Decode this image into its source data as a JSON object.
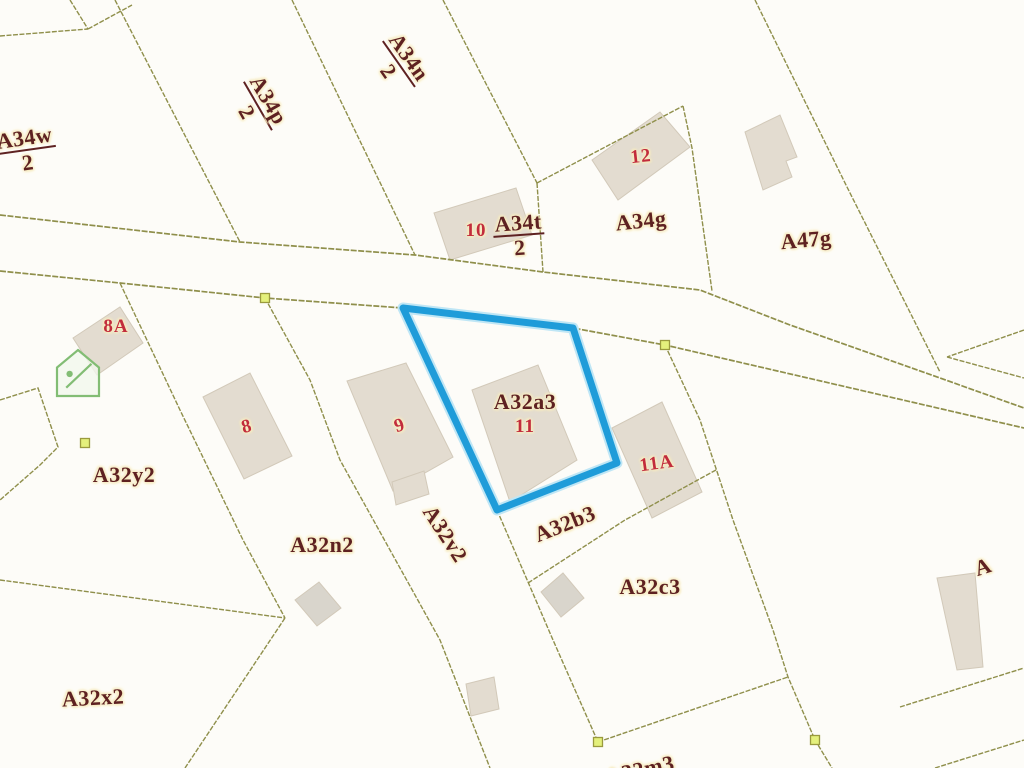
{
  "map": {
    "type": "cadastral-parcel-map",
    "highlighted_parcel": {
      "label": "A32a3",
      "house_number": "11",
      "outline_color": "#1f9cd9",
      "polygon": [
        [
          403,
          308
        ],
        [
          573,
          328
        ],
        [
          617,
          463
        ],
        [
          497,
          510
        ]
      ]
    },
    "colors": {
      "background": "#fdfcf8",
      "boundary_line": "#8f8f4b",
      "building_fill_beige": "#e3dcd0",
      "building_fill_gray": "#d9d5cc",
      "building_stroke": "#d2c9b9",
      "parcel_label": "#5e2121",
      "house_number": "#c22c3c",
      "label_halo": "#f7ecc2",
      "vertex_marker_fill": "#e4f07c",
      "vertex_marker_stroke": "#9a9a3e",
      "house_icon_green": "#82bd74"
    },
    "labels": [
      {
        "kind": "parcel",
        "fraction": [
          "A34w",
          "2"
        ],
        "x": 26,
        "y": 150,
        "rot": -8,
        "partial": true
      },
      {
        "kind": "parcel",
        "fraction": [
          "A34p",
          "2"
        ],
        "x": 258,
        "y": 106,
        "rot": 60
      },
      {
        "kind": "parcel",
        "fraction": [
          "A34n",
          "2"
        ],
        "x": 399,
        "y": 64,
        "rot": 55
      },
      {
        "kind": "parcel",
        "fraction": [
          "A34t",
          "2"
        ],
        "x": 519,
        "y": 235,
        "rot": -4
      },
      {
        "kind": "number",
        "text": "10",
        "x": 476,
        "y": 231,
        "rot": 0
      },
      {
        "kind": "parcel",
        "text": "A34g",
        "x": 641,
        "y": 221,
        "rot": -6
      },
      {
        "kind": "parcel",
        "text": "A47g",
        "x": 806,
        "y": 240,
        "rot": -5
      },
      {
        "kind": "number",
        "text": "12",
        "x": 641,
        "y": 157,
        "rot": -6
      },
      {
        "kind": "number",
        "text": "8A",
        "x": 116,
        "y": 327,
        "rot": 0
      },
      {
        "kind": "parcel",
        "text": "A32y2",
        "x": 124,
        "y": 475,
        "rot": 0
      },
      {
        "kind": "number",
        "text": "8",
        "x": 247,
        "y": 427,
        "rot": -15
      },
      {
        "kind": "number",
        "text": "9",
        "x": 400,
        "y": 426,
        "rot": -18
      },
      {
        "kind": "parcel",
        "text": "A32a3",
        "x": 525,
        "y": 402,
        "rot": 0
      },
      {
        "kind": "number",
        "text": "11",
        "x": 525,
        "y": 427,
        "rot": 0
      },
      {
        "kind": "number",
        "text": "11A",
        "x": 657,
        "y": 464,
        "rot": -8
      },
      {
        "kind": "parcel",
        "text": "A32b3",
        "x": 565,
        "y": 524,
        "rot": -22
      },
      {
        "kind": "parcel",
        "text": "A32n2",
        "x": 322,
        "y": 545,
        "rot": 0
      },
      {
        "kind": "parcel",
        "text": "A32v2",
        "x": 445,
        "y": 534,
        "rot": 57
      },
      {
        "kind": "parcel",
        "text": "A32c3",
        "x": 650,
        "y": 587,
        "rot": 0
      },
      {
        "kind": "parcel",
        "text": "A32x2",
        "x": 93,
        "y": 698,
        "rot": -3
      },
      {
        "kind": "parcel",
        "text": "A32m3",
        "x": 640,
        "y": 770,
        "rot": -12,
        "partial": true
      },
      {
        "kind": "parcel",
        "text": "A",
        "x": 983,
        "y": 567,
        "rot": -18,
        "partial": true
      }
    ],
    "roads": [
      [
        [
          0,
          215
        ],
        [
          240,
          242
        ],
        [
          415,
          255
        ],
        [
          543,
          272
        ],
        [
          700,
          290
        ],
        [
          790,
          325
        ],
        [
          940,
          378
        ],
        [
          1024,
          408
        ]
      ],
      [
        [
          0,
          271
        ],
        [
          120,
          283
        ],
        [
          265,
          298
        ],
        [
          403,
          308
        ],
        [
          573,
          328
        ],
        [
          665,
          345
        ],
        [
          1024,
          428
        ]
      ]
    ],
    "boundary_lines": [
      [
        [
          0,
          36
        ],
        [
          88,
          29
        ]
      ],
      [
        [
          70,
          0
        ],
        [
          88,
          29
        ]
      ],
      [
        [
          88,
          29
        ],
        [
          132,
          5
        ]
      ],
      [
        [
          115,
          0
        ],
        [
          240,
          242
        ]
      ],
      [
        [
          292,
          0
        ],
        [
          415,
          255
        ]
      ],
      [
        [
          443,
          0
        ],
        [
          537,
          183
        ]
      ],
      [
        [
          537,
          183
        ],
        [
          543,
          272
        ]
      ],
      [
        [
          537,
          183
        ],
        [
          683,
          106
        ]
      ],
      [
        [
          683,
          106
        ],
        [
          692,
          148
        ],
        [
          712,
          291
        ]
      ],
      [
        [
          755,
          0
        ],
        [
          847,
          187
        ],
        [
          940,
          372
        ]
      ],
      [
        [
          1024,
          330
        ],
        [
          947,
          357
        ]
      ],
      [
        [
          947,
          357
        ],
        [
          1024,
          378
        ]
      ],
      [
        [
          665,
          345
        ],
        [
          700,
          420
        ],
        [
          733,
          520
        ],
        [
          773,
          630
        ],
        [
          788,
          677
        ],
        [
          815,
          740
        ],
        [
          832,
          768
        ]
      ],
      [
        [
          265,
          298
        ],
        [
          310,
          380
        ],
        [
          340,
          460
        ],
        [
          440,
          640
        ],
        [
          490,
          768
        ]
      ],
      [
        [
          497,
          510
        ],
        [
          553,
          640
        ],
        [
          598,
          742
        ]
      ],
      [
        [
          598,
          742
        ],
        [
          788,
          677
        ]
      ],
      [
        [
          716,
          470
        ],
        [
          625,
          520
        ],
        [
          528,
          583
        ]
      ],
      [
        [
          120,
          283
        ],
        [
          180,
          410
        ],
        [
          243,
          540
        ],
        [
          285,
          618
        ]
      ],
      [
        [
          0,
          580
        ],
        [
          285,
          618
        ]
      ],
      [
        [
          285,
          618
        ],
        [
          185,
          768
        ]
      ],
      [
        [
          0,
          400
        ],
        [
          38,
          388
        ],
        [
          58,
          447
        ],
        [
          40,
          465
        ],
        [
          0,
          500
        ]
      ],
      [
        [
          900,
          707
        ],
        [
          1024,
          668
        ]
      ],
      [
        [
          935,
          768
        ],
        [
          1024,
          740
        ]
      ]
    ],
    "buildings": [
      {
        "name": "building-10",
        "tone": "beige",
        "pts": [
          [
            434,
            213
          ],
          [
            516,
            188
          ],
          [
            532,
            235
          ],
          [
            450,
            260
          ]
        ]
      },
      {
        "name": "building-12",
        "tone": "beige",
        "pts": [
          [
            592,
            160
          ],
          [
            660,
            112
          ],
          [
            690,
            147
          ],
          [
            618,
            200
          ]
        ]
      },
      {
        "name": "building-a47g",
        "tone": "beige",
        "pts": [
          [
            745,
            132
          ],
          [
            780,
            115
          ],
          [
            797,
            157
          ],
          [
            786,
            161
          ],
          [
            792,
            177
          ],
          [
            763,
            190
          ]
        ]
      },
      {
        "name": "building-8a",
        "tone": "beige",
        "pts": [
          [
            73,
            338
          ],
          [
            120,
            307
          ],
          [
            143,
            343
          ],
          [
            97,
            375
          ]
        ]
      },
      {
        "name": "building-8",
        "tone": "beige",
        "pts": [
          [
            203,
            397
          ],
          [
            250,
            373
          ],
          [
            292,
            456
          ],
          [
            244,
            479
          ]
        ]
      },
      {
        "name": "building-9",
        "tone": "beige",
        "pts": [
          [
            347,
            381
          ],
          [
            406,
            363
          ],
          [
            453,
            457
          ],
          [
            393,
            491
          ]
        ]
      },
      {
        "name": "building-11",
        "tone": "beige",
        "pts": [
          [
            472,
            390
          ],
          [
            538,
            365
          ],
          [
            577,
            460
          ],
          [
            510,
            502
          ]
        ]
      },
      {
        "name": "building-11a",
        "tone": "beige",
        "pts": [
          [
            612,
            428
          ],
          [
            662,
            402
          ],
          [
            702,
            492
          ],
          [
            652,
            518
          ]
        ]
      },
      {
        "name": "building-small-a32n2",
        "tone": "gray",
        "pts": [
          [
            295,
            600
          ],
          [
            319,
            582
          ],
          [
            341,
            608
          ],
          [
            317,
            626
          ]
        ]
      },
      {
        "name": "building-small-strip-top",
        "tone": "beige",
        "pts": [
          [
            392,
            482
          ],
          [
            424,
            471
          ],
          [
            429,
            494
          ],
          [
            396,
            505
          ]
        ]
      },
      {
        "name": "building-small-strip-bottom",
        "tone": "beige",
        "pts": [
          [
            466,
            684
          ],
          [
            494,
            677
          ],
          [
            499,
            709
          ],
          [
            471,
            716
          ]
        ]
      },
      {
        "name": "building-small-a32c3",
        "tone": "gray",
        "pts": [
          [
            541,
            592
          ],
          [
            563,
            573
          ],
          [
            584,
            598
          ],
          [
            561,
            617
          ]
        ]
      },
      {
        "name": "building-partial-right",
        "tone": "beige",
        "pts": [
          [
            937,
            578
          ],
          [
            975,
            573
          ],
          [
            983,
            667
          ],
          [
            957,
            670
          ]
        ]
      }
    ],
    "vertex_markers": [
      [
        265,
        298
      ],
      [
        665,
        345
      ],
      [
        85,
        443
      ],
      [
        598,
        742
      ],
      [
        815,
        740
      ]
    ],
    "house_icon": {
      "x": 57,
      "y": 350,
      "w": 42,
      "h": 46
    }
  }
}
